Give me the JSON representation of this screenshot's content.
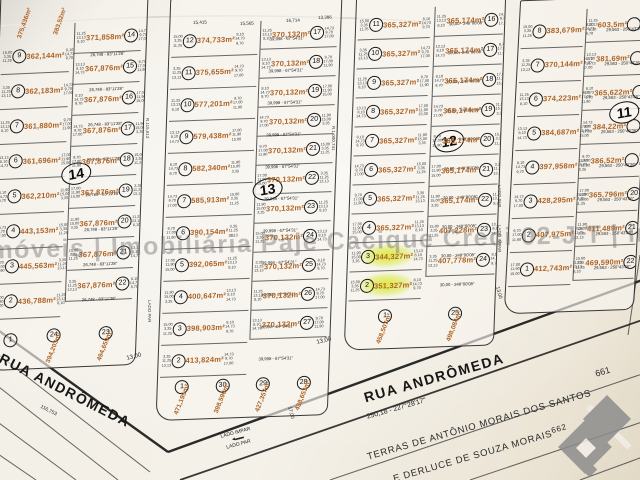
{
  "photo": {
    "watermark_text": "infoimóveis | Imobiliária Paje Cacique Creci 02-J T | infoimóveis"
  },
  "streets": {
    "rua_andromeda_left": "RUA ANDRÔMEDA",
    "rua_andromeda_bottom": "RUA ANDRÔMEDA"
  },
  "boundary": {
    "terras_line": "TERRAS DE ANTÔNIO MORAIS DOS SANTOS",
    "terras_line2": "E DERLUCE DE SOUZA MORAIS",
    "marker_661": "661",
    "marker_662": "662",
    "bearing": "250,18 - 227°28'17\"",
    "dist_116": "116,753"
  },
  "labels": {
    "lado_impar": "LADO IMPAR",
    "lado_par": "LADO PAR",
    "dim_13": "13,00",
    "dim_17": "17,00",
    "corridor1": "R.115,613",
    "corridor2": "R.1.000,741",
    "top_dims": [
      "15,415",
      "15,565",
      "16,714",
      "13,386"
    ]
  },
  "edge_number_pool": [
    "15,00",
    "3,35",
    "11,25",
    "13,13",
    "8,10",
    "14,73",
    "9,70",
    "17,00",
    "11,90"
  ],
  "highlight_color": "#d8e834",
  "area_color": "#ad6223",
  "blocks": [
    {
      "id": "14",
      "label": "14",
      "label_pos": [
        66,
        168
      ],
      "pos": [
        -6,
        -6,
        146,
        372
      ],
      "skew": [
        -2,
        -2.5
      ],
      "top_fragments": [
        {
          "t": "375,436m²",
          "x": 16,
          "y": 40
        },
        {
          "t": "383,52m²",
          "x": 52,
          "y": 38
        }
      ],
      "cols": [
        {
          "x": 2,
          "w": 68,
          "top": 42,
          "row_h": 34,
          "dim": "26,748 - 83°11'28\"",
          "lots": [
            {
              "n": "9",
              "a": "362,144m²"
            },
            {
              "n": "8",
              "a": "362,183m²"
            },
            {
              "n": "7",
              "a": "361,880m²"
            },
            {
              "n": "6",
              "a": "361,696m²"
            },
            {
              "n": "5",
              "a": "362,210m²"
            },
            {
              "n": "4",
              "a": "443,153m²"
            },
            {
              "n": "3",
              "a": "445,563m²"
            },
            {
              "n": "2",
              "a": "436,788m²"
            }
          ]
        },
        {
          "x": 74,
          "w": 66,
          "top": 28,
          "row_h": 30,
          "dim": "30,00 - 84°27'1\"",
          "lots": [
            {
              "n": "14",
              "a": "371,858m²"
            },
            {
              "n": "15",
              "a": "367,876m²"
            },
            {
              "n": "16",
              "a": "367,876m²"
            },
            {
              "n": "17",
              "a": "367,876m²"
            },
            {
              "n": "18",
              "a": "367,876m²"
            },
            {
              "n": "19",
              "a": "367,876m²"
            },
            {
              "n": "20",
              "a": "367,876m²"
            },
            {
              "n": "21",
              "a": "367,876m²"
            },
            {
              "n": "22",
              "a": "367,876m²"
            }
          ]
        }
      ],
      "bottom": [
        {
          "n": "1",
          "a": ""
        },
        {
          "n": "24",
          "a": "394,203m²"
        },
        {
          "n": "23",
          "a": "494,659m²"
        }
      ]
    },
    {
      "id": "13",
      "label": "13",
      "label_pos": [
        88,
        182
      ],
      "pos": [
        163,
        -4,
        170,
        420
      ],
      "skew": [
        -2,
        -2
      ],
      "top_fragments": [],
      "cols": [
        {
          "x": 2,
          "w": 86,
          "top": 26,
          "row_h": 31,
          "dim": "39,998 - 67°54'31\"",
          "lots": [
            {
              "n": "12",
              "a": "374,733m²"
            },
            {
              "n": "11",
              "a": "375,655m²"
            },
            {
              "n": "10",
              "a": "577,201m²"
            },
            {
              "n": "9",
              "a": "579,438m²"
            },
            {
              "n": "8",
              "a": "582,340m²"
            },
            {
              "n": "7",
              "a": "585,913m²"
            },
            {
              "n": "6",
              "a": "390,154m²"
            },
            {
              "n": "5",
              "a": "392,065m²"
            },
            {
              "n": "4",
              "a": "400,647m²"
            },
            {
              "n": "3",
              "a": "398,903m²"
            },
            {
              "n": "2",
              "a": "413,824m²"
            }
          ]
        },
        {
          "x": 90,
          "w": 76,
          "top": 24,
          "row_h": 28,
          "dim": "30,00 - 248°12'32\"",
          "lots": [
            {
              "n": "17",
              "a": "370,132m²"
            },
            {
              "n": "18",
              "a": "370,132m²"
            },
            {
              "n": "19",
              "a": "370,132m²"
            },
            {
              "n": "20",
              "a": "370,132m²"
            },
            {
              "n": "21",
              "a": "370,132m²"
            },
            {
              "n": "22",
              "a": "370,132m²"
            },
            {
              "n": "23",
              "a": "370,132m²"
            },
            {
              "n": "24",
              "a": "370,132m²"
            },
            {
              "n": "25",
              "a": "370,132m²"
            },
            {
              "n": "26",
              "a": "370,132m²"
            },
            {
              "n": "27",
              "a": "370,132m²"
            }
          ]
        }
      ],
      "bottom": [
        {
          "n": "1",
          "a": "471,195m²"
        },
        {
          "n": "30",
          "a": "398,590m²"
        },
        {
          "n": "29",
          "a": "427,357m²"
        },
        {
          "n": "28",
          "a": "438,653m²"
        }
      ]
    },
    {
      "id": "12",
      "label": "12",
      "label_pos": [
        82,
        134
      ],
      "pos": [
        350,
        -4,
        148,
        350
      ],
      "skew": [
        -2,
        -2
      ],
      "top_fragments": [],
      "cols": [
        {
          "x": 2,
          "w": 72,
          "top": 12,
          "row_h": 28,
          "dim": "30,00 - 248°00'08\"",
          "lots": [
            {
              "n": "11",
              "a": "365,327m²"
            },
            {
              "n": "10",
              "a": "365,327m²"
            },
            {
              "n": "9",
              "a": "365,327m²"
            },
            {
              "n": "8",
              "a": "365,327m²"
            },
            {
              "n": "7",
              "a": "365,327m²"
            },
            {
              "n": "6",
              "a": "365,327m²"
            },
            {
              "n": "5",
              "a": "365,327m²"
            },
            {
              "n": "4",
              "a": "365,327m²"
            },
            {
              "n": "3",
              "a": "344,327m²",
              "hl": true
            },
            {
              "n": "2",
              "a": "351,327m²",
              "hl": true
            }
          ]
        },
        {
          "x": 78,
          "w": 68,
          "top": 10,
          "row_h": 29,
          "dim": "30,00 - 247°08'38\"",
          "lots": [
            {
              "n": "16",
              "a": "365,174m²"
            },
            {
              "n": "17",
              "a": "365,174m²"
            },
            {
              "n": "18",
              "a": "365,174m²"
            },
            {
              "n": "19",
              "a": "365,174m²"
            },
            {
              "n": "20",
              "a": "365,174m²"
            },
            {
              "n": "21",
              "a": "365,174m²"
            },
            {
              "n": "22",
              "a": "365,174m²"
            },
            {
              "n": "23",
              "a": "407,228m²"
            },
            {
              "n": "24",
              "a": "407,778m²"
            }
          ]
        }
      ],
      "bottom": [
        {
          "n": "1",
          "a": "458,507m²"
        },
        {
          "n": "25",
          "a": "498,084m²"
        }
      ]
    },
    {
      "id": "11",
      "label": "11",
      "label_pos": [
        94,
        104
      ],
      "pos": [
        512,
        -2,
        128,
        312
      ],
      "skew": [
        -3,
        -2
      ],
      "top_fragments": [],
      "cols": [
        {
          "x": 2,
          "w": 62,
          "top": 14,
          "row_h": 33,
          "dim": "29,563 - 250°43'36\"",
          "lots": [
            {
              "n": "8",
              "a": "383,679m²"
            },
            {
              "n": "7",
              "a": "370,144m²"
            },
            {
              "n": "6",
              "a": "374,223m²"
            },
            {
              "n": "5",
              "a": "384,687m²"
            },
            {
              "n": "4",
              "a": "397,958m²"
            },
            {
              "n": "3",
              "a": "428,295m²"
            },
            {
              "n": "2",
              "a": "407,975m²"
            },
            {
              "n": "1",
              "a": "412,743m²"
            }
          ]
        },
        {
          "x": 66,
          "w": 60,
          "top": 10,
          "row_h": 33,
          "dim": "70°43'59\"",
          "lots": [
            {
              "n": "",
              "a": "603,5m²"
            },
            {
              "n": "",
              "a": "381,69m²"
            },
            {
              "n": "",
              "a": "365,622m²"
            },
            {
              "n": "",
              "a": "384,22m²"
            },
            {
              "n": "",
              "a": "386,52m²"
            },
            {
              "n": "20",
              "a": "365,796m²"
            },
            {
              "n": "21",
              "a": "411,489m²"
            },
            {
              "n": "22",
              "a": "469,590m²"
            }
          ]
        }
      ],
      "bottom": []
    }
  ]
}
